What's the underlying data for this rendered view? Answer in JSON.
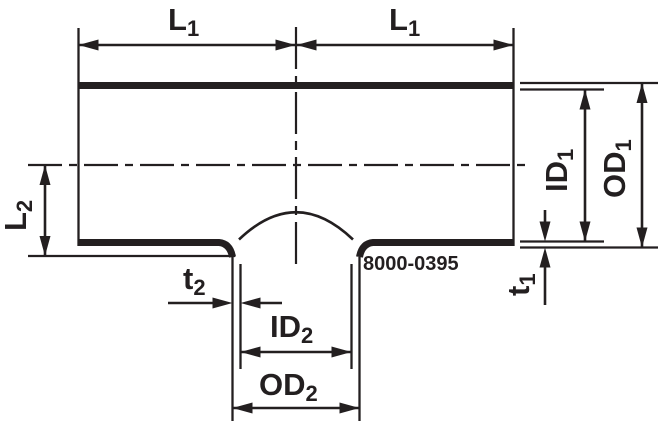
{
  "drawing": {
    "part_number": "8000-0395",
    "colors": {
      "ink": "#231f20",
      "paper": "#ffffff"
    },
    "labels": {
      "length_run_left": {
        "main": "L",
        "sub": "1"
      },
      "length_run_right": {
        "main": "L",
        "sub": "1"
      },
      "length_branch": {
        "main": "L",
        "sub": "2"
      },
      "inner_diameter_run": {
        "main": "ID",
        "sub": "1"
      },
      "outer_diameter_run": {
        "main": "OD",
        "sub": "1"
      },
      "wall_thickness_run": {
        "main": "t",
        "sub": "1"
      },
      "wall_thickness_branch": {
        "main": "t",
        "sub": "2"
      },
      "inner_diameter_branch": {
        "main": "ID",
        "sub": "2"
      },
      "outer_diameter_branch": {
        "main": "OD",
        "sub": "2"
      }
    }
  }
}
